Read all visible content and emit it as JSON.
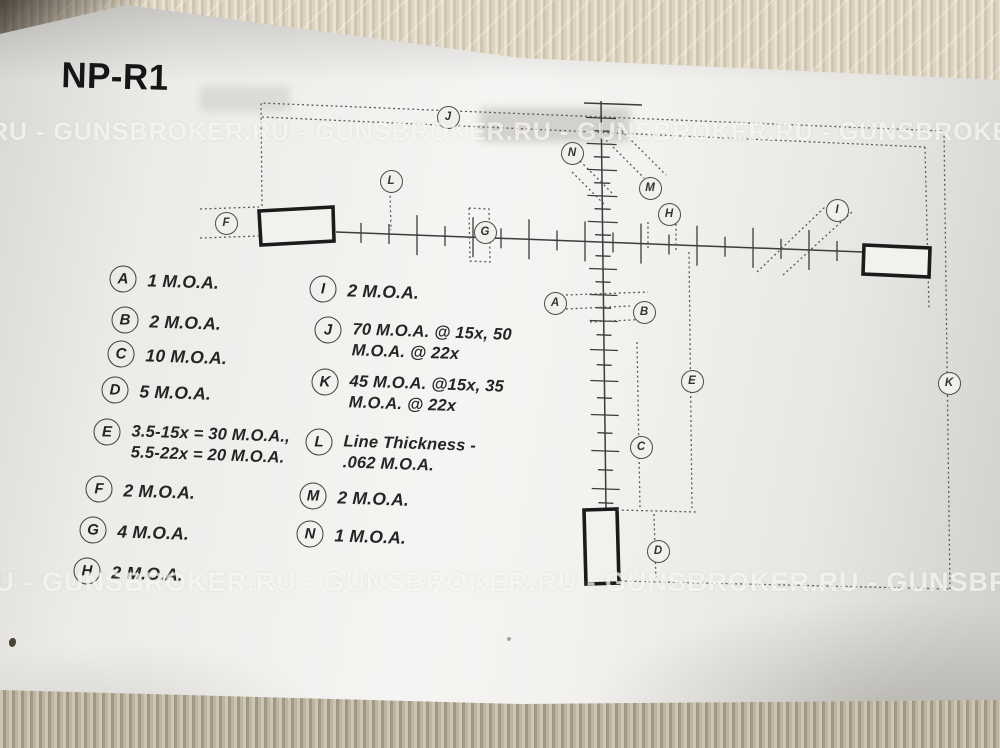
{
  "page": {
    "title": "NP-R1"
  },
  "watermark": {
    "text": "GUNSBROKER.RU",
    "top_band": "RU - GUNSBROKER.RU - GUNSBROKER.RU - GUNSBROKER.RU - GUNSBROKER.RU - GUNSBROKER.RU",
    "bottom_band": "RU - GUNSBROKER.RU - GUNSBROKER.RU - GUNSBROKER.RU - GUNSBROKER.RU - GUNSBROKER.RU"
  },
  "legend": {
    "items": [
      {
        "key": "A",
        "value": "1 M.O.A."
      },
      {
        "key": "B",
        "value": "2 M.O.A."
      },
      {
        "key": "C",
        "value": "10 M.O.A."
      },
      {
        "key": "D",
        "value": "5 M.O.A."
      },
      {
        "key": "E",
        "value": "3.5-15x = 30 M.O.A.,\n5.5-22x = 20 M.O.A."
      },
      {
        "key": "F",
        "value": "2 M.O.A."
      },
      {
        "key": "G",
        "value": "4 M.O.A."
      },
      {
        "key": "H",
        "value": "2 M.O.A."
      },
      {
        "key": "I",
        "value": "2 M.O.A."
      },
      {
        "key": "J",
        "value": "70 M.O.A. @ 15x, 50\nM.O.A. @ 22x"
      },
      {
        "key": "K",
        "value": "45 M.O.A. @15x, 35\nM.O.A. @ 22x"
      },
      {
        "key": "L",
        "value": "Line Thickness -\n.062  M.O.A."
      },
      {
        "key": "M",
        "value": "2 M.O.A."
      },
      {
        "key": "N",
        "value": "1 M.O.A."
      }
    ]
  },
  "diagram": {
    "markers": {
      "a": "A",
      "b": "B",
      "c": "C",
      "d": "D",
      "e": "E",
      "f": "F",
      "g": "G",
      "h": "H",
      "i": "I",
      "j": "J",
      "k": "K",
      "l": "L",
      "m": "M",
      "n": "N"
    }
  },
  "colors": {
    "paper": "#f1f0ed",
    "fabric_top": "#d9d0bf",
    "fabric_bottom": "#b8af9e",
    "ink": "#2e2e2e",
    "watermark": "#ffffff"
  }
}
